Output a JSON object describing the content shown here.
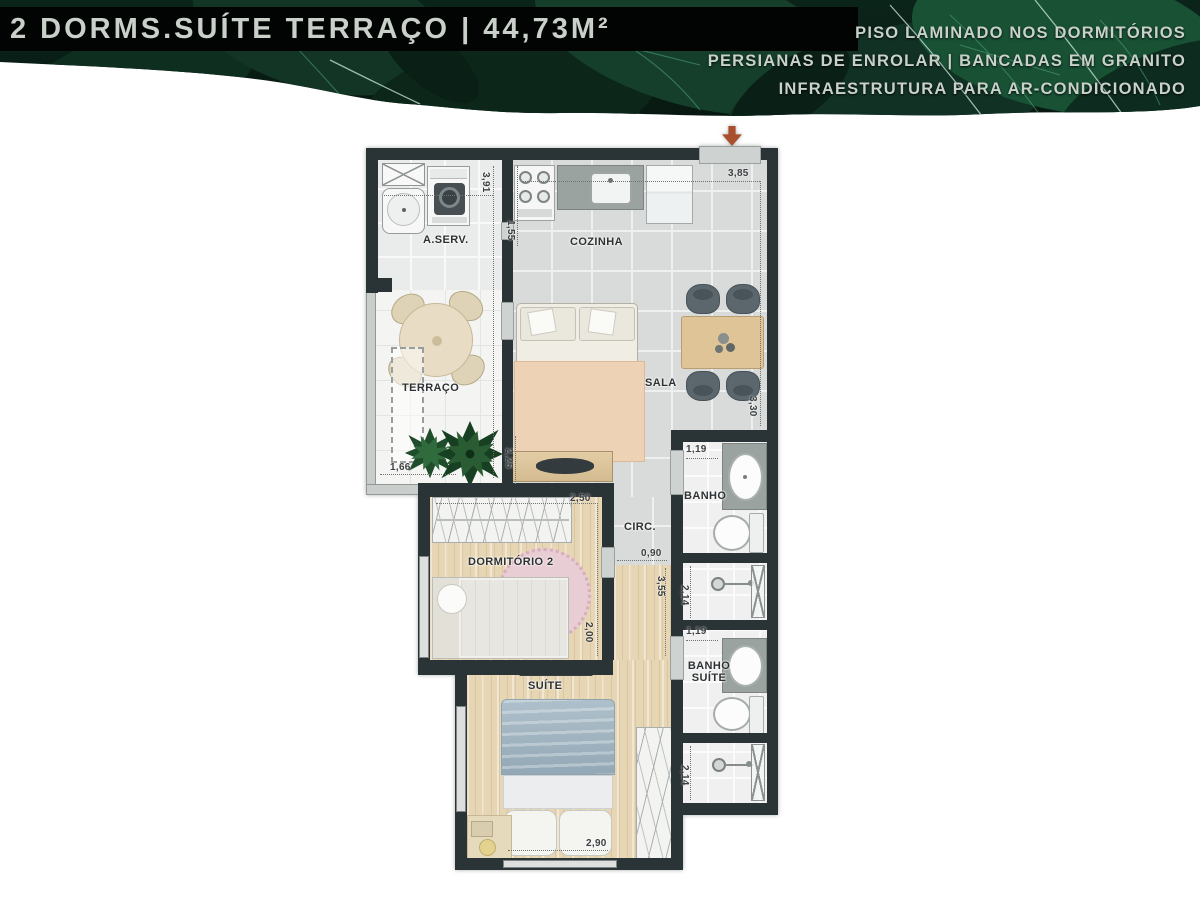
{
  "banner": {
    "title": "2 DORMS.SUÍTE TERRAÇO | 44,73M²",
    "features": [
      "PISO LAMINADO NOS DORMITÓRIOS",
      "PERSIANAS DE ENROLAR | BANCADAS EM GRANITO",
      "INFRAESTRUTURA PARA AR-CONDICIONADO"
    ],
    "colors": {
      "band": "#020403",
      "leaf_dark": "#0b241a",
      "leaf_light": "#185134",
      "text": "#c9d1cb"
    }
  },
  "plan": {
    "rooms": {
      "aserv": "A.SERV.",
      "cozinha": "COZINHA",
      "terraco": "TERRAÇO",
      "sala": "SALA",
      "circ": "CIRC.",
      "dormitorio2": "DORMITÓRIO 2",
      "banho": "BANHO",
      "suite": "SUÍTE",
      "banho_suite": "BANHO SUÍTE"
    },
    "dims": {
      "left_column_h": "3,91",
      "kitchen_depth": "1,55",
      "kitchen_width": "3,85",
      "living_h": "3,30",
      "tv_wall": "2,25",
      "terrace_w": "1,66",
      "bedroom2_w": "2,50",
      "bedroom2_h": "2,00",
      "circulation_w": "0,90",
      "hall_h": "3,55",
      "bath_w": "1,19",
      "bath_shower_h": "2,14",
      "bath2_w": "1,19",
      "bath2_shower_h": "2,14",
      "suite_w": "2,90"
    },
    "icons": {
      "entry_arrow": "down-arrow"
    },
    "colors": {
      "wall": "#2a3335",
      "wood": "#e7d6b4",
      "tile": "#d9dbda",
      "entry_arrow": "#a8502e",
      "suite_bed": "#9fb3c0",
      "rug_pink": "#e9cdd4"
    }
  }
}
